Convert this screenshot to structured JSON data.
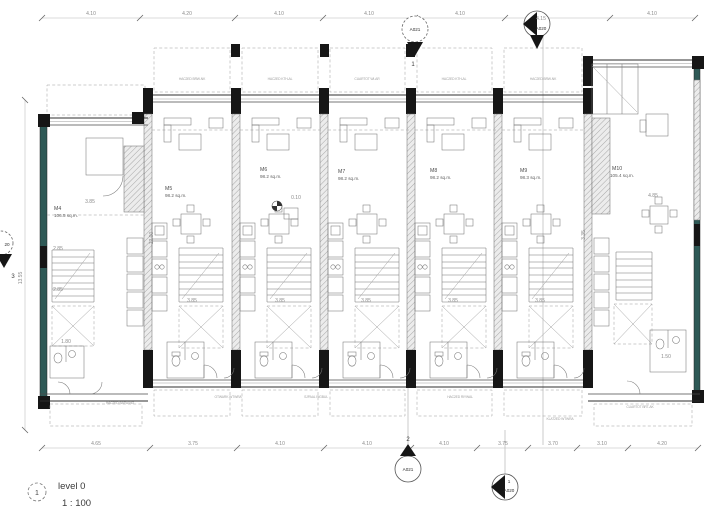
{
  "drawing": {
    "title": {
      "view_number": "1",
      "name": "level 0",
      "scale": "1 : 100"
    },
    "units": [
      {
        "id": "M4",
        "area": "106.5 sq.m."
      },
      {
        "id": "M5",
        "area": "98.2 sq.m."
      },
      {
        "id": "M6",
        "area": "98.2 sq.m."
      },
      {
        "id": "M7",
        "area": "98.2 sq.m."
      },
      {
        "id": "M8",
        "area": "98.2 sq.m."
      },
      {
        "id": "M9",
        "area": "98.3 sq.m."
      },
      {
        "id": "M10",
        "area": "105.4 sq.m."
      }
    ],
    "dims": {
      "top": [
        "4.10",
        "4.20",
        "4.10",
        "4.10",
        "4.10",
        "4.15",
        "4.10"
      ],
      "bottom": [
        "4.65",
        "3.75",
        "4.10",
        "4.10",
        "4.10",
        "3.75",
        "3.70",
        "3.10",
        "4.20"
      ],
      "left_total": "13.55",
      "interior": {
        "u_mid": "3.85",
        "m4_a": "3.85",
        "m4_b": "2.85",
        "m4_c": "2.85",
        "m4_d": "1.80",
        "m5_v": "12.00",
        "m6_t": "0.10",
        "m10_v": "3.35",
        "m10_a": "1.50",
        "m10_b": "4.85"
      }
    },
    "markers": {
      "top_a021": {
        "id": "A021",
        "num": "1"
      },
      "top_a020": {
        "id": "A020"
      },
      "bottom_a021": {
        "id": "A021",
        "num": "2"
      },
      "bottom_a020": {
        "id": "A020",
        "num": "1"
      },
      "left": {
        "id": "20",
        "num": "3"
      }
    },
    "annotations": {
      "top": [
        "HAC2ED BRW-NK",
        "HAC2ED KTH-AL",
        "CUARTOT WI-AR",
        "HAC2ED KTH-AL",
        "HAC2ED BRW-NK"
      ],
      "bottom": [
        "HAC2ED BATW-NG",
        "OTWARK WTWRA",
        "SJPAAL RIGBUL",
        "HAC2ED RIYWAL",
        "KLAT2ED WTWRA",
        "CUARTOT BRT-AK"
      ]
    },
    "palette": {
      "wall_black": "#161616",
      "wall_teal": "#2e5956",
      "line_gray": "#777777",
      "dim_gray": "#8b8b8b",
      "background": "#ffffff"
    }
  }
}
